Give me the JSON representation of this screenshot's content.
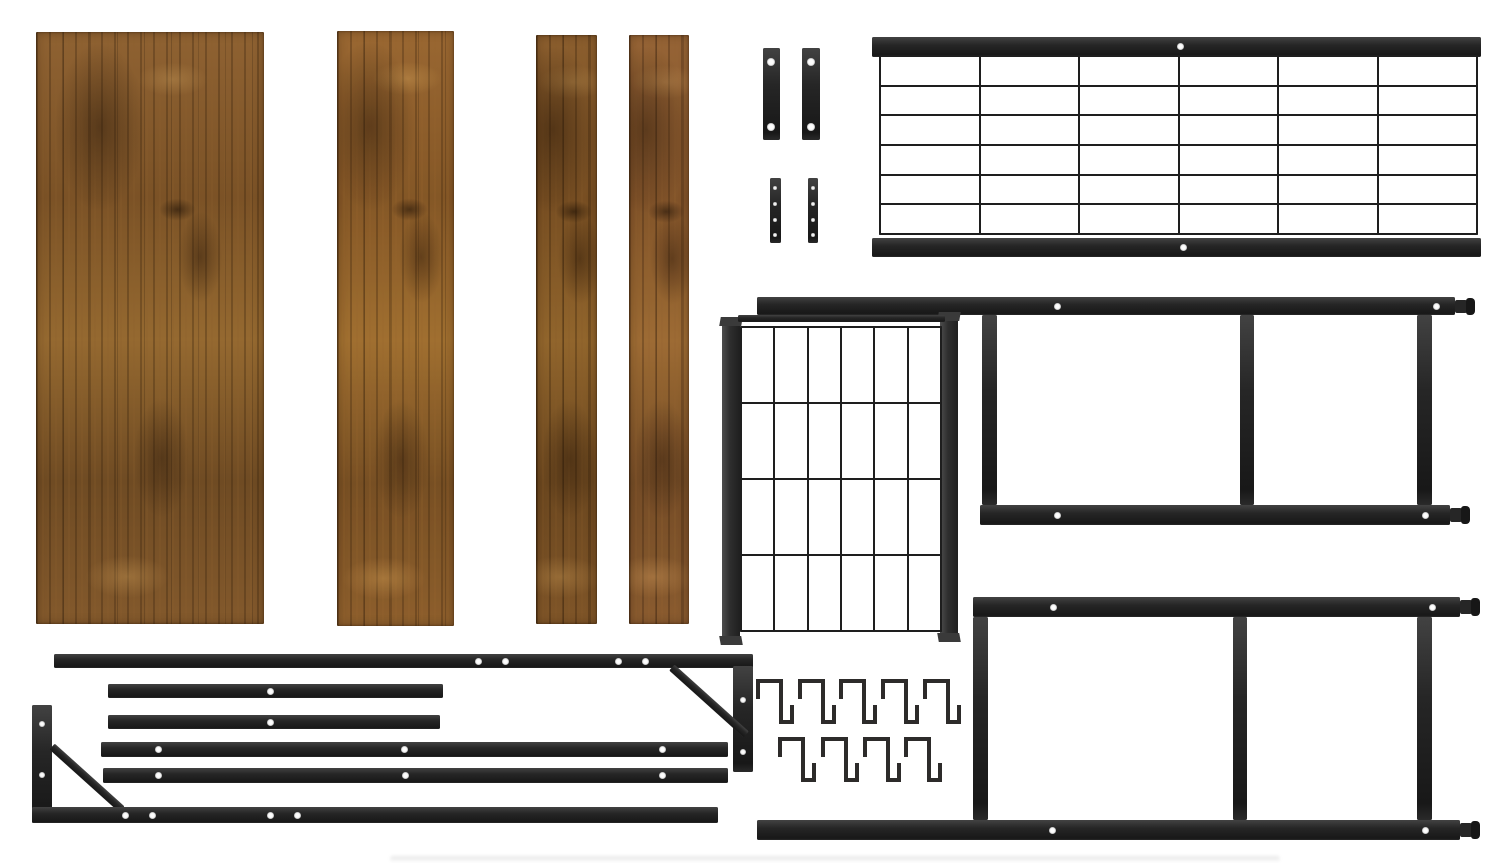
{
  "alt_text": "Flat lay of unassembled furniture kit parts: four rustic brown wood panels, black metal wire grid panels, two ladder-style side frames with screw holes and end pegs, mounting brackets, long rails with corner braces, and nine black square S-hooks on a white background.",
  "canvas": {
    "width": 1500,
    "height": 863,
    "background": "#ffffff"
  },
  "palette": {
    "metal": "#262626",
    "metal_dark": "#171717",
    "metal_mid": "#3a3a3a",
    "wire": "#1e1e1e",
    "hole": "#fdfdfd",
    "wood_base": "#8a5c2e",
    "wood_dark": "#4f351a",
    "wood_light": "#c89a55",
    "background": "#ffffff"
  },
  "hook": {
    "points": "3,22 3,4 26,4 26,45 37,45 37,28",
    "stroke": "#2d2b2a",
    "stroke_width": 4
  },
  "parts": [
    {
      "type": "shadow",
      "name": "floor-shadow",
      "x": 390,
      "y": 856,
      "w": 890,
      "h": 6
    },
    {
      "type": "wood",
      "name": "wood-panel-large",
      "x": 36,
      "y": 32,
      "w": 228,
      "h": 592,
      "variant": 0
    },
    {
      "type": "wood",
      "name": "wood-panel-medium",
      "x": 337,
      "y": 31,
      "w": 117,
      "h": 595,
      "variant": 1
    },
    {
      "type": "wood",
      "name": "wood-slat-1",
      "x": 536,
      "y": 35,
      "w": 61,
      "h": 589,
      "variant": 2
    },
    {
      "type": "wood",
      "name": "wood-slat-2",
      "x": 629,
      "y": 35,
      "w": 60,
      "h": 589,
      "variant": 3
    },
    {
      "type": "rect",
      "name": "hinge-bracket-1",
      "x": 763,
      "y": 48,
      "w": 17,
      "h": 92,
      "holes": [
        {
          "cx": 8,
          "cy": 14,
          "d": 8
        },
        {
          "cx": 8,
          "cy": 79,
          "d": 8
        }
      ]
    },
    {
      "type": "rect",
      "name": "hinge-bracket-2",
      "x": 802,
      "y": 48,
      "w": 18,
      "h": 92,
      "holes": [
        {
          "cx": 9,
          "cy": 14,
          "d": 8
        },
        {
          "cx": 9,
          "cy": 79,
          "d": 8
        }
      ]
    },
    {
      "type": "rect",
      "name": "flat-plate-1",
      "x": 770,
      "y": 178,
      "w": 11,
      "h": 65,
      "holes": [
        {
          "cx": 5,
          "cy": 10,
          "d": 4
        },
        {
          "cx": 5,
          "cy": 26,
          "d": 4
        },
        {
          "cx": 5,
          "cy": 42,
          "d": 4
        },
        {
          "cx": 5,
          "cy": 57,
          "d": 4
        }
      ]
    },
    {
      "type": "rect",
      "name": "flat-plate-2",
      "x": 808,
      "y": 178,
      "w": 10,
      "h": 65,
      "holes": [
        {
          "cx": 5,
          "cy": 10,
          "d": 4
        },
        {
          "cx": 5,
          "cy": 26,
          "d": 4
        },
        {
          "cx": 5,
          "cy": 42,
          "d": 4
        },
        {
          "cx": 5,
          "cy": 57,
          "d": 4
        }
      ]
    },
    {
      "type": "rect",
      "name": "top-grid-frame-top-bar",
      "x": 872,
      "y": 37,
      "w": 609,
      "h": 20,
      "holes": [
        {
          "cx": 308,
          "cy": 9,
          "d": 7
        }
      ]
    },
    {
      "type": "grid",
      "name": "top-grid-mesh",
      "x": 879,
      "y": 55,
      "w": 599,
      "h": 180,
      "cols": 6,
      "rows": 6
    },
    {
      "type": "rect",
      "name": "top-grid-frame-bottom-bar",
      "x": 872,
      "y": 238,
      "w": 609,
      "h": 19,
      "holes": [
        {
          "cx": 311,
          "cy": 9,
          "d": 7
        }
      ]
    },
    {
      "type": "rect",
      "name": "frame1-top-rail",
      "x": 757,
      "y": 297,
      "w": 698,
      "h": 18,
      "holes": [
        {
          "cx": 300,
          "cy": 9,
          "d": 7
        },
        {
          "cx": 679,
          "cy": 9,
          "d": 7
        }
      ]
    },
    {
      "type": "peg",
      "name": "frame1-top-rail-peg",
      "x": 1455,
      "y": 300,
      "w": 12,
      "h": 13
    },
    {
      "type": "rect",
      "name": "frame1-left-upright",
      "x": 982,
      "y": 315,
      "w": 15,
      "h": 190
    },
    {
      "type": "rect",
      "name": "frame1-middle-upright",
      "x": 1240,
      "y": 315,
      "w": 14,
      "h": 190
    },
    {
      "type": "rect",
      "name": "frame1-right-upright",
      "x": 1417,
      "y": 315,
      "w": 15,
      "h": 190
    },
    {
      "type": "rect",
      "name": "frame1-bottom-rail",
      "x": 980,
      "y": 505,
      "w": 470,
      "h": 20,
      "holes": [
        {
          "cx": 77,
          "cy": 10,
          "d": 7
        },
        {
          "cx": 445,
          "cy": 10,
          "d": 7
        }
      ]
    },
    {
      "type": "peg",
      "name": "frame1-bottom-rail-peg",
      "x": 1450,
      "y": 508,
      "w": 12,
      "h": 14
    },
    {
      "type": "fbar",
      "name": "center-grid-left-bar",
      "x": 722,
      "y": 322,
      "w": 18,
      "h": 318
    },
    {
      "type": "fbar",
      "name": "center-grid-right-bar",
      "x": 940,
      "y": 317,
      "w": 18,
      "h": 320
    },
    {
      "type": "rect",
      "name": "center-grid-top-bar",
      "x": 738,
      "y": 315,
      "w": 207,
      "h": 7
    },
    {
      "type": "grid",
      "name": "center-grid-mesh",
      "x": 740,
      "y": 326,
      "w": 202,
      "h": 306,
      "cols": 6,
      "rows": 4
    },
    {
      "type": "rect",
      "name": "frame2-top-rail",
      "x": 973,
      "y": 597,
      "w": 487,
      "h": 20,
      "holes": [
        {
          "cx": 80,
          "cy": 10,
          "d": 7
        },
        {
          "cx": 459,
          "cy": 10,
          "d": 7
        }
      ]
    },
    {
      "type": "peg",
      "name": "frame2-top-rail-peg",
      "x": 1460,
      "y": 600,
      "w": 12,
      "h": 14
    },
    {
      "type": "rect",
      "name": "frame2-left-upright",
      "x": 973,
      "y": 617,
      "w": 15,
      "h": 203
    },
    {
      "type": "rect",
      "name": "frame2-middle-upright",
      "x": 1233,
      "y": 617,
      "w": 14,
      "h": 203
    },
    {
      "type": "rect",
      "name": "frame2-right-upright",
      "x": 1417,
      "y": 617,
      "w": 15,
      "h": 203
    },
    {
      "type": "rect",
      "name": "frame2-bottom-rail",
      "x": 757,
      "y": 820,
      "w": 703,
      "h": 20,
      "holes": [
        {
          "cx": 295,
          "cy": 10,
          "d": 7
        },
        {
          "cx": 668,
          "cy": 10,
          "d": 7
        }
      ]
    },
    {
      "type": "peg",
      "name": "frame2-bottom-rail-peg",
      "x": 1460,
      "y": 823,
      "w": 12,
      "h": 14
    },
    {
      "type": "hook",
      "name": "s-hook-1",
      "x": 755,
      "y": 677,
      "w": 40,
      "h": 53
    },
    {
      "type": "hook",
      "name": "s-hook-2",
      "x": 797,
      "y": 677,
      "w": 40,
      "h": 53
    },
    {
      "type": "hook",
      "name": "s-hook-3",
      "x": 838,
      "y": 677,
      "w": 40,
      "h": 53
    },
    {
      "type": "hook",
      "name": "s-hook-4",
      "x": 880,
      "y": 677,
      "w": 40,
      "h": 53
    },
    {
      "type": "hook",
      "name": "s-hook-5",
      "x": 922,
      "y": 677,
      "w": 40,
      "h": 53
    },
    {
      "type": "hook",
      "name": "s-hook-6",
      "x": 777,
      "y": 735,
      "w": 40,
      "h": 53
    },
    {
      "type": "hook",
      "name": "s-hook-7",
      "x": 820,
      "y": 735,
      "w": 40,
      "h": 53
    },
    {
      "type": "hook",
      "name": "s-hook-8",
      "x": 862,
      "y": 735,
      "w": 40,
      "h": 53
    },
    {
      "type": "hook",
      "name": "s-hook-9",
      "x": 903,
      "y": 735,
      "w": 40,
      "h": 53
    },
    {
      "type": "rect",
      "name": "support-rail-top",
      "x": 54,
      "y": 654,
      "w": 699,
      "h": 14,
      "holes": [
        {
          "cx": 424,
          "cy": 7,
          "d": 7
        },
        {
          "cx": 451,
          "cy": 7,
          "d": 7
        },
        {
          "cx": 564,
          "cy": 7,
          "d": 7
        },
        {
          "cx": 591,
          "cy": 7,
          "d": 7
        }
      ]
    },
    {
      "type": "rect",
      "name": "support-rail-top-end-drop",
      "x": 733,
      "y": 666,
      "w": 20,
      "h": 106,
      "holes": [
        {
          "cx": 10,
          "cy": 34,
          "d": 6
        },
        {
          "cx": 10,
          "cy": 86,
          "d": 6
        }
      ]
    },
    {
      "type": "diag",
      "name": "support-rail-top-brace",
      "x": 659,
      "y": 697,
      "w": 100,
      "h": 8,
      "rot": 42
    },
    {
      "type": "rect",
      "name": "short-rail-1",
      "x": 108,
      "y": 684,
      "w": 335,
      "h": 14,
      "holes": [
        {
          "cx": 162,
          "cy": 7,
          "d": 7
        }
      ]
    },
    {
      "type": "rect",
      "name": "short-rail-2",
      "x": 108,
      "y": 715,
      "w": 332,
      "h": 14,
      "holes": [
        {
          "cx": 162,
          "cy": 7,
          "d": 7
        }
      ]
    },
    {
      "type": "rect",
      "name": "long-rail-1",
      "x": 101,
      "y": 742,
      "w": 627,
      "h": 15,
      "holes": [
        {
          "cx": 57,
          "cy": 7,
          "d": 7
        },
        {
          "cx": 303,
          "cy": 7,
          "d": 7
        },
        {
          "cx": 561,
          "cy": 7,
          "d": 7
        }
      ]
    },
    {
      "type": "rect",
      "name": "long-rail-2",
      "x": 103,
      "y": 768,
      "w": 625,
      "h": 15,
      "holes": [
        {
          "cx": 55,
          "cy": 7,
          "d": 7
        },
        {
          "cx": 302,
          "cy": 7,
          "d": 7
        },
        {
          "cx": 559,
          "cy": 7,
          "d": 7
        }
      ]
    },
    {
      "type": "rect",
      "name": "support-rail-bottom-end-drop",
      "x": 32,
      "y": 705,
      "w": 20,
      "h": 118,
      "holes": [
        {
          "cx": 10,
          "cy": 19,
          "d": 6
        },
        {
          "cx": 10,
          "cy": 70,
          "d": 6
        }
      ]
    },
    {
      "type": "diag",
      "name": "support-rail-bottom-brace",
      "x": 40,
      "y": 774,
      "w": 94,
      "h": 8,
      "rot": 42
    },
    {
      "type": "rect",
      "name": "support-rail-bottom",
      "x": 32,
      "y": 807,
      "w": 686,
      "h": 16,
      "holes": [
        {
          "cx": 93,
          "cy": 8,
          "d": 7
        },
        {
          "cx": 120,
          "cy": 8,
          "d": 7
        },
        {
          "cx": 238,
          "cy": 8,
          "d": 7
        },
        {
          "cx": 265,
          "cy": 8,
          "d": 7
        }
      ]
    }
  ]
}
